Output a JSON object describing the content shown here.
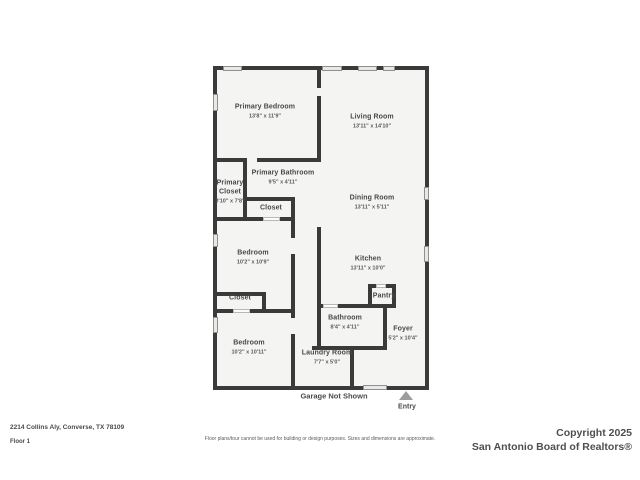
{
  "plan": {
    "colors": {
      "wall": "#3a3a3a",
      "floor_fill": "#f4f4f3",
      "window_fill": "#e8e8e7",
      "label_text": "#4a4a4a"
    },
    "rooms": [
      {
        "name": "Primary Bedroom",
        "dims": "13'8\" x 11'9\""
      },
      {
        "name": "Living Room",
        "dims": "13'11\" x 14'10\""
      },
      {
        "name": "Primary Bathroom",
        "dims": "9'5\" x 4'11\""
      },
      {
        "name": "Primary Closet",
        "dims": "3'10\" x 7'8\""
      },
      {
        "name": "Closet",
        "dims": ""
      },
      {
        "name": "Dining Room",
        "dims": "13'11\" x 5'11\""
      },
      {
        "name": "Bedroom",
        "dims": "10'2\" x 10'9\""
      },
      {
        "name": "Kitchen",
        "dims": "13'11\" x 10'0\""
      },
      {
        "name": "Closet",
        "dims": ""
      },
      {
        "name": "Pantry",
        "dims": ""
      },
      {
        "name": "Bathroom",
        "dims": "8'4\" x 4'11\""
      },
      {
        "name": "Bedroom",
        "dims": "10'2\" x 10'11\""
      },
      {
        "name": "Laundry Room",
        "dims": "7'7\" x 5'0\""
      },
      {
        "name": "Foyer",
        "dims": "5'2\" x 10'4\""
      }
    ],
    "annotations": {
      "garage_note": "Garage Not Shown",
      "entry_label": "Entry"
    }
  },
  "footer": {
    "address": "2214 Collins Aly, Converse, TX 78109",
    "floor_label": "Floor 1",
    "disclaimer": "Floor plans/tour cannot be used for building or design purposes. Sizes and dimensions are approximate.",
    "copyright_line1": "Copyright 2025",
    "copyright_line2": "San Antonio Board of Realtors®"
  }
}
